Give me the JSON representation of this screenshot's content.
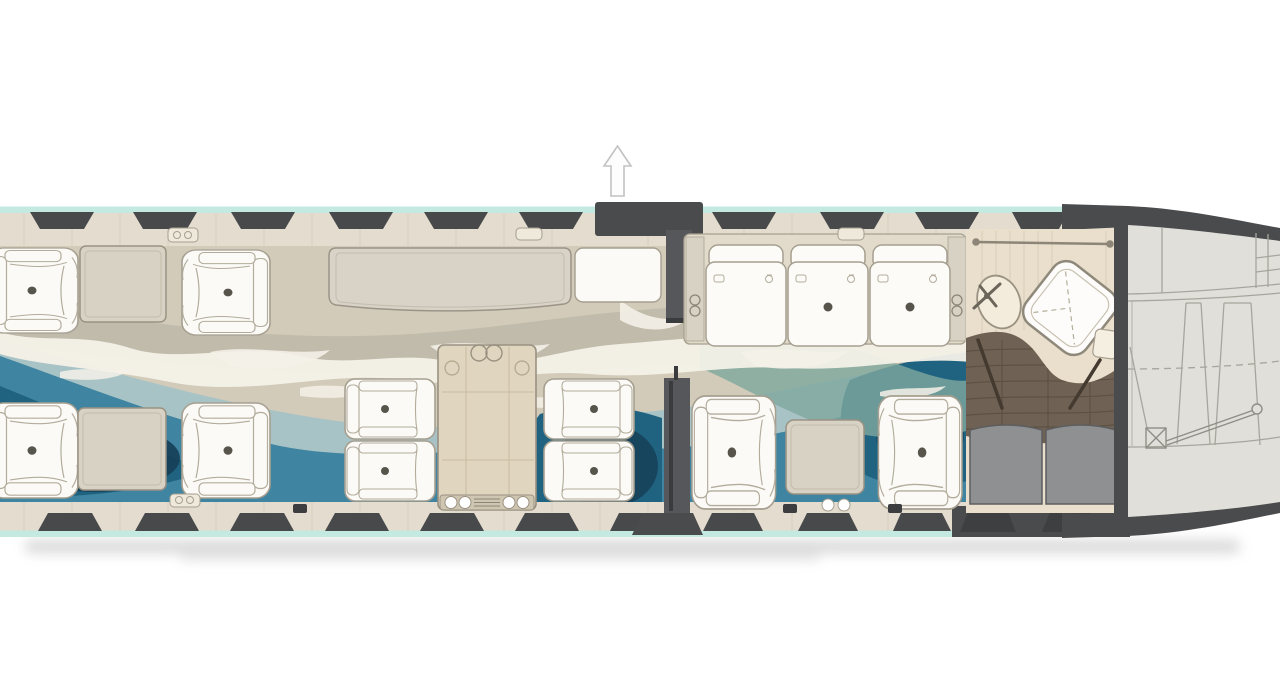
{
  "meta": {
    "title": "Business jet cabin floor plan (top view)",
    "view": "plan",
    "artwork": "ocean-wave carpet design",
    "orientation_arrow": "up"
  },
  "colors": {
    "background": "#ffffff",
    "hull_wall": "#4a4b4d",
    "window": "#48494b",
    "window_dim": "#3e3f41",
    "trim_teal": "#c3e9e1",
    "sill": "#e4ddcf",
    "sill_line": "#c2bbab",
    "carpet_sand": "#d2cbba",
    "carpet_sand2": "#bdb8a7",
    "carpet_foam": "#f4f1e8",
    "sea_pale": "#a3c2c6",
    "sea_mid": "#3f84a0",
    "sea_deep": "#1f6381",
    "sea_navy": "#153f57",
    "sea_green": "#7fa79e",
    "furniture_white": "#fbfaf6",
    "furniture_line": "#a69f90",
    "cabinet_beige": "#d8d2c4",
    "table_wood": "#e0d5bf",
    "lav_counter": "#e9dfcc",
    "lav_floor_wood": "#6f6153",
    "closet_gray": "#8e9092",
    "aft_bay_gray": "#e1dfda",
    "aft_bay_line": "#a8a59d",
    "partition_gray": "#56575a",
    "seat_dot": "#57544c",
    "arrow_outline": "#c2c2c2"
  },
  "windows": {
    "top_count": 10,
    "bottom_count": 12
  },
  "sections": [
    {
      "id": "forward-club",
      "label": "Forward club section",
      "seats": 4,
      "side_tables": 2,
      "credenza": 1
    },
    {
      "id": "dining",
      "label": "Four-place dining / conference group",
      "seats": 4,
      "tables": 1
    },
    {
      "id": "entry",
      "label": "Entry door vestibule",
      "partitions": 2,
      "indicator": "up-arrow"
    },
    {
      "id": "aft-lounge",
      "label": "Aft lounge",
      "divan_seats": 3,
      "club_seats": 2,
      "side_tables": 1
    },
    {
      "id": "lavatory",
      "label": "Aft lavatory",
      "fixtures": [
        "vanity-sink",
        "shower-seat",
        "wardrobe-closets"
      ]
    },
    {
      "id": "aft-bay",
      "label": "Aft baggage / equipment bay"
    }
  ]
}
